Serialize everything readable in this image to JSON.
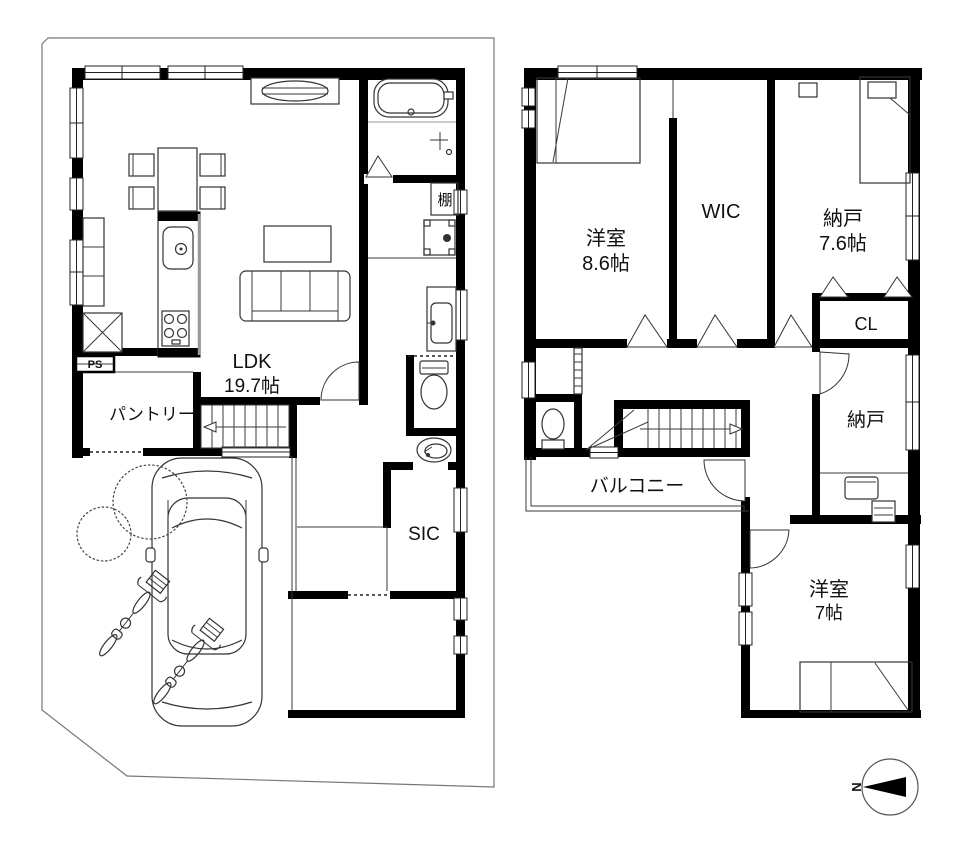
{
  "floor1": {
    "rooms": [
      {
        "id": "ldk",
        "name": "LDK",
        "size": "19.7帖"
      },
      {
        "id": "pantry",
        "name": "パントリー"
      },
      {
        "id": "ps",
        "name": "PS"
      },
      {
        "id": "shelf",
        "name": "棚"
      },
      {
        "id": "sic",
        "name": "SIC"
      }
    ]
  },
  "floor2": {
    "rooms": [
      {
        "id": "bedroom-86",
        "name": "洋室",
        "size": "8.6帖"
      },
      {
        "id": "wic",
        "name": "WIC"
      },
      {
        "id": "storage-76",
        "name": "納戸",
        "size": "7.6帖"
      },
      {
        "id": "cl",
        "name": "CL"
      },
      {
        "id": "storage-2",
        "name": "納戸"
      },
      {
        "id": "balcony",
        "name": "バルコニー"
      },
      {
        "id": "bedroom-7",
        "name": "洋室",
        "size": "7帖"
      }
    ]
  },
  "compass": {
    "north": "N"
  },
  "colors": {
    "wall": "#000000",
    "site_outline": "#777777",
    "text": "#111111"
  }
}
